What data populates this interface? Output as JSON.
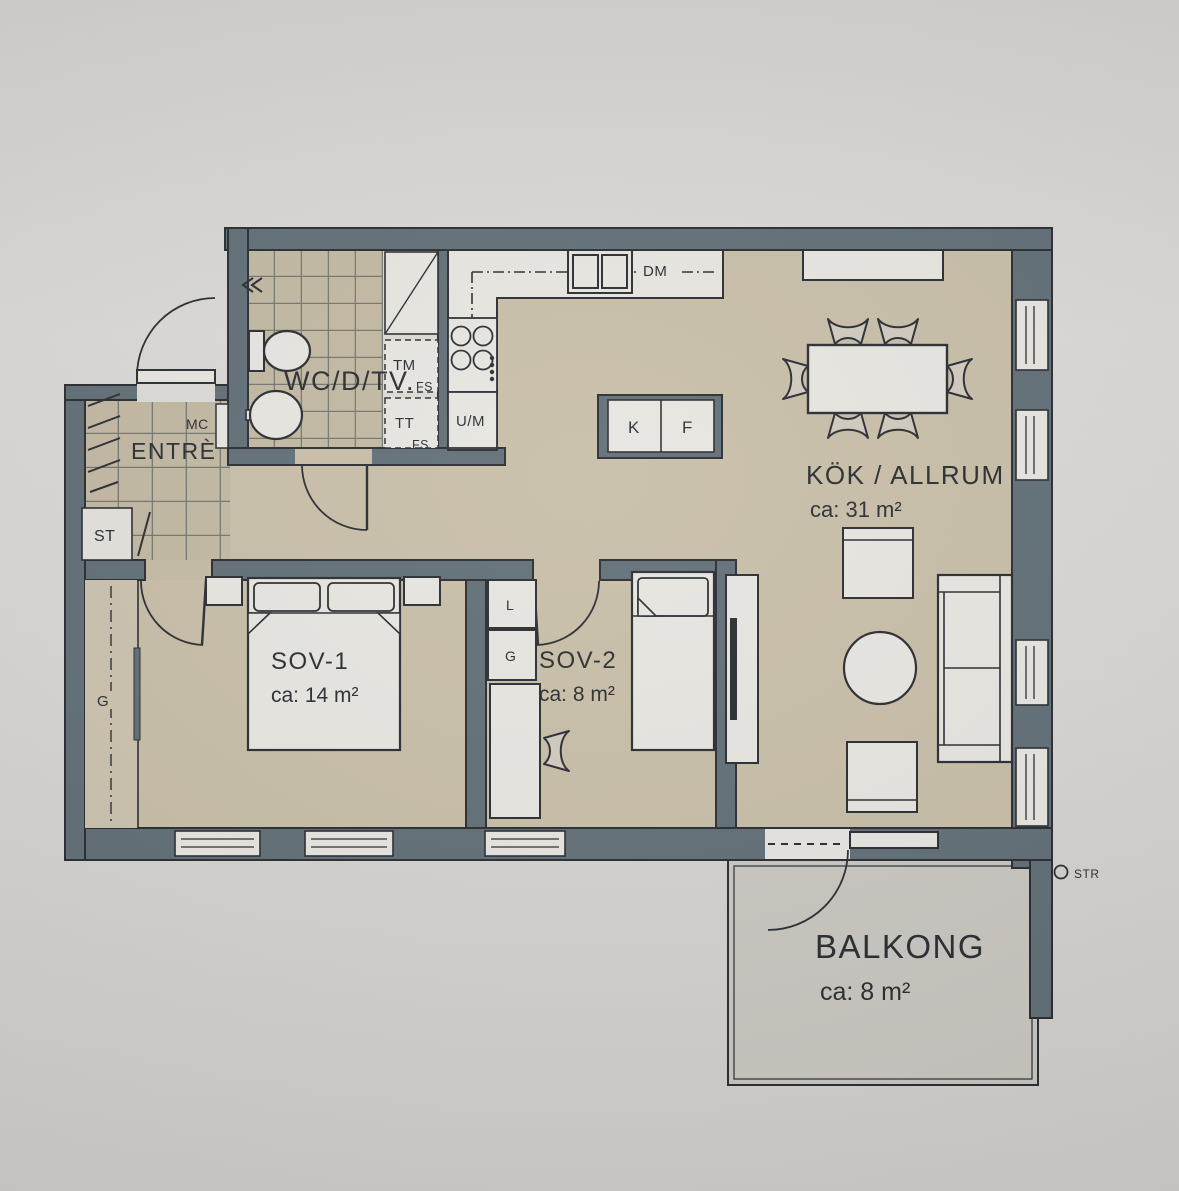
{
  "rooms": {
    "wc": {
      "label": "WC/D/TV."
    },
    "entre": {
      "label": "ENTRÈ"
    },
    "kitchen": {
      "label": "KÖK / ALLRUM",
      "area": "ca: 31 m²"
    },
    "bedroom1": {
      "label": "SOV-1",
      "area": "ca: 14 m²"
    },
    "bedroom2": {
      "label": "SOV-2",
      "area": "ca: 8 m²"
    },
    "balcony": {
      "label": "BALKONG",
      "area": "ca: 8 m²"
    }
  },
  "fixtures": {
    "media_cabinet": "MC",
    "cleaning_closet": "ST",
    "hall_wardrobe": "G",
    "washing_machine": "TM",
    "washer_note": "FS",
    "dryer": "TT",
    "dryer_note": "FS",
    "oven_microwave": "U/M",
    "dishwasher": "DM",
    "fridge": "K",
    "freezer": "F",
    "linen_closet": "L",
    "bedroom2_wardrobe": "G",
    "downpipe": "STR"
  },
  "colors": {
    "paper": "#d8d6d2",
    "wall": "#5e6c74",
    "floor": "#c7bda7",
    "tile_floor": "#c1b7a1",
    "balcony_floor": "#c9c6c0",
    "fixture_white": "#e7e5e0",
    "line": "#26292d"
  }
}
